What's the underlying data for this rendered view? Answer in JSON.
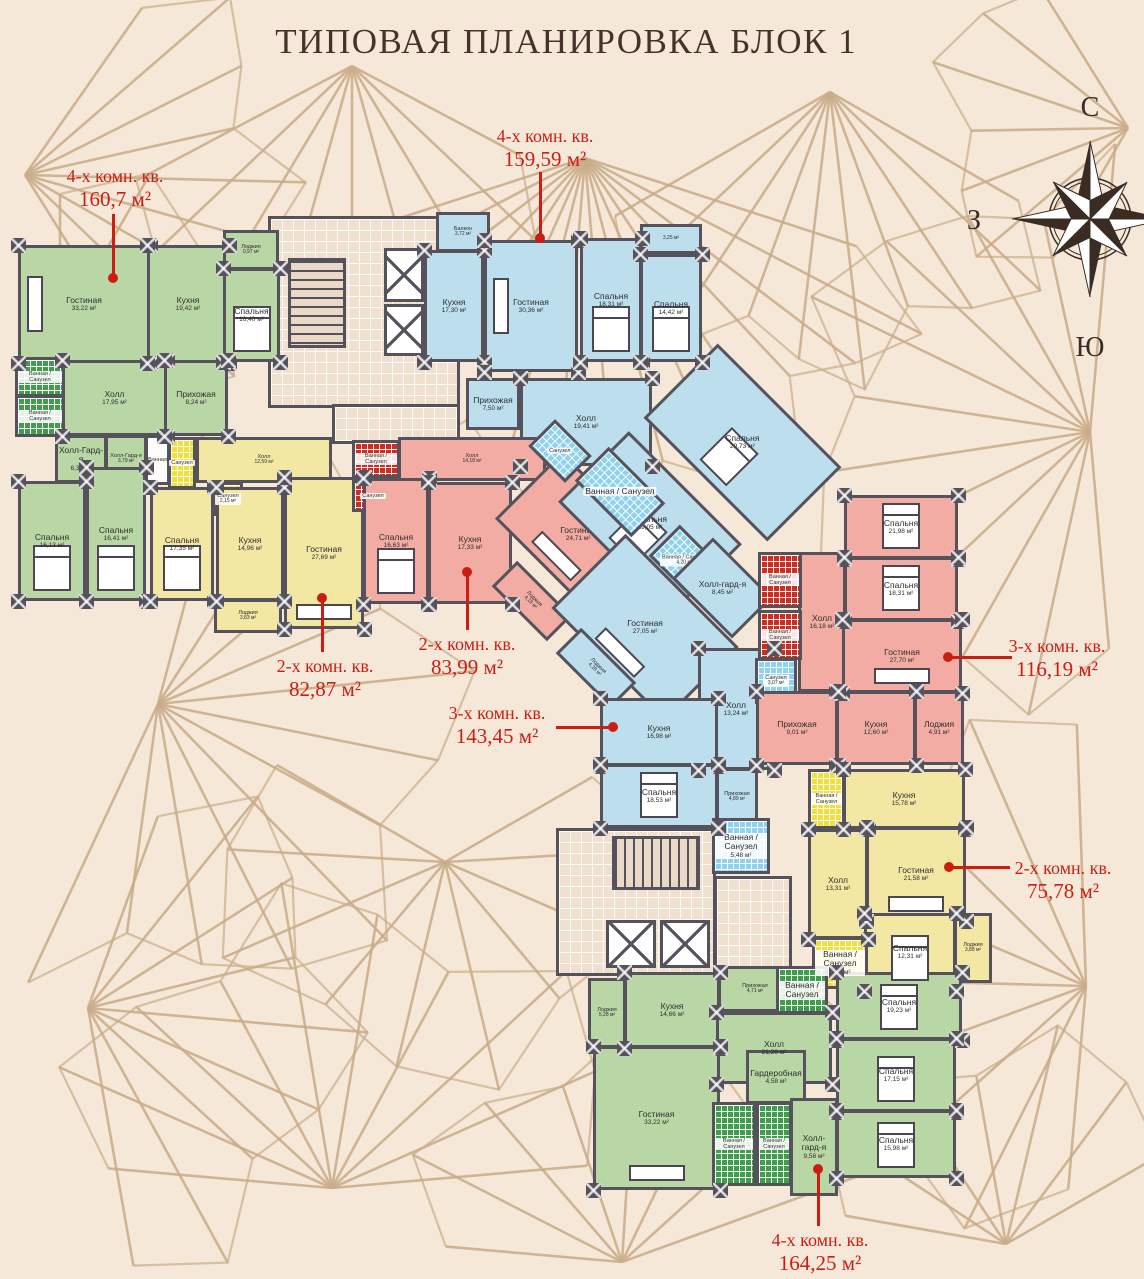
{
  "title": "ТИПОВАЯ ПЛАНИРОВКА БЛОК 1",
  "compass": {
    "north": "С",
    "south": "Ю",
    "west": "З"
  },
  "colors": {
    "background": "#f6e8d9",
    "pattern_line": "#c9ac88",
    "wall": "#55525b",
    "callout_red": "#cc1d12",
    "room_green": "#b9d6a5",
    "room_blue": "#bcdeed",
    "room_yellow": "#f2e7a3",
    "room_pink": "#f2aca4"
  },
  "plan": {
    "rooms": [
      {
        "name": "",
        "area": "",
        "type": "core",
        "x": 268,
        "y": 216,
        "w": 192,
        "h": 192
      },
      {
        "name": "",
        "area": "",
        "type": "core",
        "x": 332,
        "y": 404,
        "w": 128,
        "h": 40
      },
      {
        "name": "",
        "area": "",
        "type": "stairs-v",
        "x": 288,
        "y": 258,
        "w": 58,
        "h": 90
      },
      {
        "name": "",
        "area": "",
        "type": "elev",
        "x": 384,
        "y": 248,
        "w": 40,
        "h": 54
      },
      {
        "name": "",
        "area": "",
        "type": "elev",
        "x": 384,
        "y": 304,
        "w": 40,
        "h": 52
      },
      {
        "name": "",
        "area": "",
        "type": "core",
        "x": 556,
        "y": 828,
        "w": 160,
        "h": 148
      },
      {
        "name": "",
        "area": "",
        "type": "core",
        "x": 714,
        "y": 876,
        "w": 78,
        "h": 100
      },
      {
        "name": "",
        "area": "",
        "type": "stairs-h",
        "x": 612,
        "y": 836,
        "w": 88,
        "h": 54
      },
      {
        "name": "",
        "area": "",
        "type": "elev",
        "x": 606,
        "y": 920,
        "w": 50,
        "h": 48
      },
      {
        "name": "",
        "area": "",
        "type": "elev",
        "x": 660,
        "y": 920,
        "w": 50,
        "h": 48
      },
      {
        "name": "Гостиная",
        "area": "33,22 м²",
        "type": "green",
        "x": 18,
        "y": 245,
        "w": 132,
        "h": 118,
        "furn": "sofa-v"
      },
      {
        "name": "Кухня",
        "area": "19,42 м²",
        "type": "green",
        "x": 147,
        "y": 245,
        "w": 82,
        "h": 118
      },
      {
        "name": "Лоджия",
        "area": "0,97 м²",
        "type": "green",
        "x": 223,
        "y": 230,
        "w": 56,
        "h": 40
      },
      {
        "name": "Спальня",
        "area": "16,40 м²",
        "type": "green",
        "x": 223,
        "y": 268,
        "w": 57,
        "h": 94,
        "furn": "bed"
      },
      {
        "name": "Холл",
        "area": "17,95 м²",
        "type": "green",
        "x": 62,
        "y": 360,
        "w": 105,
        "h": 76
      },
      {
        "name": "Прихожая",
        "area": "8,24 м²",
        "type": "green",
        "x": 164,
        "y": 360,
        "w": 64,
        "h": 76
      },
      {
        "name": "Ванная / Санузел",
        "area": "",
        "type": "tile-green",
        "x": 15,
        "y": 357,
        "w": 50,
        "h": 40
      },
      {
        "name": "Ванная / Санузел",
        "area": "",
        "type": "tile-green",
        "x": 15,
        "y": 395,
        "w": 50,
        "h": 42
      },
      {
        "name": "Холл-Гард-я",
        "area": "6,33 м²",
        "type": "green",
        "x": 55,
        "y": 435,
        "w": 52,
        "h": 48
      },
      {
        "name": "Холл-Гард-я",
        "area": "3,79 м²",
        "type": "green",
        "x": 105,
        "y": 435,
        "w": 42,
        "h": 48
      },
      {
        "name": "Спальня",
        "area": "16,13 м²",
        "type": "green",
        "x": 18,
        "y": 481,
        "w": 68,
        "h": 120,
        "furn": "bed"
      },
      {
        "name": "Спальня",
        "area": "16,41 м²",
        "type": "green",
        "x": 86,
        "y": 467,
        "w": 60,
        "h": 134,
        "furn": "bed"
      },
      {
        "name": "Ванная",
        "area": "",
        "type": "white",
        "x": 145,
        "y": 435,
        "w": 25,
        "h": 50
      },
      {
        "name": "Санузел",
        "area": "",
        "type": "tile-yellow",
        "x": 168,
        "y": 437,
        "w": 28,
        "h": 52
      },
      {
        "name": "Холл",
        "area": "12,59 м²",
        "type": "yellow",
        "x": 196,
        "y": 437,
        "w": 136,
        "h": 46
      },
      {
        "name": "Санузел",
        "area": "2,15 м²",
        "type": "tile-yellow",
        "x": 213,
        "y": 482,
        "w": 30,
        "h": 34
      },
      {
        "name": "Спальня",
        "area": "17,35 м²",
        "type": "yellow",
        "x": 150,
        "y": 487,
        "w": 64,
        "h": 114,
        "furn": "bed"
      },
      {
        "name": "Кухня",
        "area": "14,96 м²",
        "type": "yellow",
        "x": 216,
        "y": 487,
        "w": 68,
        "h": 114
      },
      {
        "name": "Гостиная",
        "area": "27,69 м²",
        "type": "yellow",
        "x": 284,
        "y": 477,
        "w": 80,
        "h": 152,
        "furn": "sofa"
      },
      {
        "name": "Лоджия",
        "area": "3,83 м²",
        "type": "yellow",
        "x": 214,
        "y": 599,
        "w": 68,
        "h": 34
      },
      {
        "name": "Балкон",
        "area": "3,72 м²",
        "type": "blue",
        "x": 436,
        "y": 212,
        "w": 54,
        "h": 40
      },
      {
        "name": "Кухня",
        "area": "17,30 м²",
        "type": "blue",
        "x": 424,
        "y": 250,
        "w": 60,
        "h": 112
      },
      {
        "name": "Гостиная",
        "area": "30,36 м²",
        "type": "blue",
        "x": 484,
        "y": 240,
        "w": 94,
        "h": 132,
        "furn": "sofa-v"
      },
      {
        "name": "Спальня",
        "area": "18,31 м²",
        "type": "blue",
        "x": 580,
        "y": 238,
        "w": 62,
        "h": 124,
        "furn": "bed"
      },
      {
        "name": "",
        "area": "3,25 м²",
        "type": "blue",
        "x": 640,
        "y": 224,
        "w": 62,
        "h": 30
      },
      {
        "name": "Спальня",
        "area": "14,42 м²",
        "type": "blue",
        "x": 640,
        "y": 254,
        "w": 62,
        "h": 108,
        "furn": "bed"
      },
      {
        "name": "Прихожая",
        "area": "7,50 м²",
        "type": "blue",
        "x": 466,
        "y": 378,
        "w": 54,
        "h": 52
      },
      {
        "name": "Холл",
        "area": "19,41 м²",
        "type": "blue",
        "x": 520,
        "y": 378,
        "w": 132,
        "h": 88
      },
      {
        "name": "Спальня",
        "area": "29,73 м²",
        "type": "blue",
        "x": 655,
        "y": 390,
        "w": 175,
        "h": 105,
        "rot": 45,
        "furn": "bed"
      },
      {
        "name": "Холл",
        "area": "14,18 м²",
        "type": "pink",
        "x": 398,
        "y": 437,
        "w": 148,
        "h": 44
      },
      {
        "name": "Ванная / Санузел",
        "area": "",
        "type": "tile-red",
        "x": 352,
        "y": 440,
        "w": 48,
        "h": 38
      },
      {
        "name": "Санузел",
        "area": "",
        "type": "tile-red",
        "x": 352,
        "y": 480,
        "w": 42,
        "h": 32
      },
      {
        "name": "Спальня",
        "area": "16,63 м²",
        "type": "pink",
        "x": 363,
        "y": 478,
        "w": 66,
        "h": 126,
        "furn": "bed"
      },
      {
        "name": "Кухня",
        "area": "17,33 м²",
        "type": "pink",
        "x": 428,
        "y": 482,
        "w": 84,
        "h": 122
      },
      {
        "name": "Гостиная",
        "area": "24,71 м²",
        "type": "pink",
        "x": 508,
        "y": 487,
        "w": 140,
        "h": 95,
        "rot": 45,
        "furn": "sofa"
      },
      {
        "name": "Лоджия",
        "area": "4,18 м²",
        "type": "pink",
        "x": 493,
        "y": 583,
        "w": 78,
        "h": 36,
        "rot": 45,
        "keepRot": 1
      },
      {
        "name": "Санузел",
        "area": "",
        "type": "tile-blue",
        "x": 534,
        "y": 432,
        "w": 52,
        "h": 38,
        "rot": 45
      },
      {
        "name": "Спальня",
        "area": "29,05 м²",
        "type": "blue",
        "x": 570,
        "y": 473,
        "w": 160,
        "h": 100,
        "rot": 45,
        "furn": "bed"
      },
      {
        "name": "Ванная / Санузел",
        "area": "",
        "type": "tile-blue",
        "x": 580,
        "y": 468,
        "w": 80,
        "h": 48,
        "rot": 45
      },
      {
        "name": "Ванная / Санузел",
        "area": "4,20 м²",
        "type": "tile-blue",
        "x": 656,
        "y": 538,
        "w": 56,
        "h": 44,
        "rot": 45
      },
      {
        "name": "Холл-гард-я",
        "area": "8,45 м²",
        "type": "blue",
        "x": 680,
        "y": 559,
        "w": 85,
        "h": 58,
        "rot": 45
      },
      {
        "name": "Гостиная",
        "area": "27,05 м²",
        "type": "blue",
        "x": 565,
        "y": 575,
        "w": 160,
        "h": 105,
        "rot": 45,
        "furn": "sofa"
      },
      {
        "name": "Лоджия",
        "area": "4,28 м²",
        "type": "blue",
        "x": 557,
        "y": 650,
        "w": 78,
        "h": 36,
        "rot": 45,
        "keepRot": 1
      },
      {
        "name": "Холл",
        "area": "13,24 м²",
        "type": "blue",
        "x": 698,
        "y": 648,
        "w": 76,
        "h": 122
      },
      {
        "name": "Санузел",
        "area": "3,07 м²",
        "type": "tile-blue",
        "x": 755,
        "y": 658,
        "w": 42,
        "h": 46
      },
      {
        "name": "Кухня",
        "area": "16,98 м²",
        "type": "blue",
        "x": 600,
        "y": 698,
        "w": 118,
        "h": 68
      },
      {
        "name": "Спальня",
        "area": "18,53 м²",
        "type": "blue",
        "x": 600,
        "y": 764,
        "w": 118,
        "h": 64,
        "furn": "bed"
      },
      {
        "name": "Прихожая",
        "area": "4,89 м²",
        "type": "blue",
        "x": 716,
        "y": 768,
        "w": 42,
        "h": 58
      },
      {
        "name": "Ванная / Санузел",
        "area": "5,48 м²",
        "type": "tile-blue",
        "x": 712,
        "y": 818,
        "w": 58,
        "h": 56
      },
      {
        "name": "Холл",
        "area": "16,18 м²",
        "type": "pink",
        "x": 798,
        "y": 552,
        "w": 48,
        "h": 140
      },
      {
        "name": "Ванная / Санузел",
        "area": "",
        "type": "tile-red",
        "x": 758,
        "y": 552,
        "w": 44,
        "h": 56
      },
      {
        "name": "Ванная / Санузел",
        "area": "",
        "type": "tile-red",
        "x": 758,
        "y": 610,
        "w": 44,
        "h": 50
      },
      {
        "name": "Спальня",
        "area": "21,98 м²",
        "type": "pink",
        "x": 844,
        "y": 495,
        "w": 114,
        "h": 64,
        "furn": "bed"
      },
      {
        "name": "Спальня",
        "area": "18,31 м²",
        "type": "pink",
        "x": 844,
        "y": 557,
        "w": 114,
        "h": 64,
        "furn": "bed"
      },
      {
        "name": "Гостиная",
        "area": "27,70 м²",
        "type": "pink",
        "x": 842,
        "y": 619,
        "w": 120,
        "h": 74,
        "furn": "sofa"
      },
      {
        "name": "Кухня",
        "area": "12,60 м²",
        "type": "pink",
        "x": 836,
        "y": 691,
        "w": 80,
        "h": 74
      },
      {
        "name": "Лоджия",
        "area": "4,91 м²",
        "type": "pink",
        "x": 914,
        "y": 691,
        "w": 50,
        "h": 74
      },
      {
        "name": "Прихожая",
        "area": "9,01 м²",
        "type": "pink",
        "x": 756,
        "y": 691,
        "w": 82,
        "h": 74
      },
      {
        "name": "Кухня",
        "area": "15,78 м²",
        "type": "yellow",
        "x": 843,
        "y": 769,
        "w": 122,
        "h": 60
      },
      {
        "name": "Ванная / Санузел",
        "area": "",
        "type": "tile-yellow",
        "x": 808,
        "y": 769,
        "w": 37,
        "h": 60
      },
      {
        "name": "Холл",
        "area": "13,31 м²",
        "type": "yellow",
        "x": 808,
        "y": 829,
        "w": 60,
        "h": 110
      },
      {
        "name": "Гостиная",
        "area": "21,58 м²",
        "type": "yellow",
        "x": 866,
        "y": 827,
        "w": 100,
        "h": 94,
        "furn": "sofa"
      },
      {
        "name": "Спальня",
        "area": "12,31 м²",
        "type": "yellow",
        "x": 864,
        "y": 913,
        "w": 92,
        "h": 78,
        "furn": "bed"
      },
      {
        "name": "Лоджия",
        "area": "3,88 м²",
        "type": "yellow",
        "x": 954,
        "y": 913,
        "w": 38,
        "h": 70
      },
      {
        "name": "Ванная / Санузел",
        "area": "4,63 м²",
        "type": "tile-yellow",
        "x": 812,
        "y": 937,
        "w": 56,
        "h": 52
      },
      {
        "name": "Лоджия",
        "area": "5,28 м²",
        "type": "green",
        "x": 588,
        "y": 978,
        "w": 38,
        "h": 70
      },
      {
        "name": "Кухня",
        "area": "14,66 м²",
        "type": "green",
        "x": 624,
        "y": 972,
        "w": 96,
        "h": 76
      },
      {
        "name": "Прихожая",
        "area": "4,71 м²",
        "type": "green",
        "x": 718,
        "y": 966,
        "w": 74,
        "h": 46
      },
      {
        "name": "Ванная / Санузел",
        "area": "",
        "type": "tile-green",
        "x": 776,
        "y": 966,
        "w": 52,
        "h": 48
      },
      {
        "name": "Холл",
        "area": "21,26 м²",
        "type": "green",
        "x": 716,
        "y": 1012,
        "w": 116,
        "h": 72
      },
      {
        "name": "Гостиная",
        "area": "33,22 м²",
        "type": "green",
        "x": 593,
        "y": 1046,
        "w": 127,
        "h": 144,
        "furn": "sofa"
      },
      {
        "name": "Гардеробная",
        "area": "4,58 м²",
        "type": "green",
        "x": 746,
        "y": 1050,
        "w": 60,
        "h": 54
      },
      {
        "name": "Холл-гард-я",
        "area": "9,58 м²",
        "type": "green",
        "x": 790,
        "y": 1098,
        "w": 48,
        "h": 98
      },
      {
        "name": "Ванная / Санузел",
        "area": "",
        "type": "tile-green",
        "x": 712,
        "y": 1102,
        "w": 44,
        "h": 84
      },
      {
        "name": "Ванная / Санузел",
        "area": "",
        "type": "tile-green",
        "x": 756,
        "y": 1102,
        "w": 36,
        "h": 84
      },
      {
        "name": "Спальня",
        "area": "19,23 м²",
        "type": "green",
        "x": 836,
        "y": 972,
        "w": 126,
        "h": 68,
        "furn": "bed"
      },
      {
        "name": "Спальня",
        "area": "17,15 м²",
        "type": "green",
        "x": 836,
        "y": 1038,
        "w": 120,
        "h": 74,
        "furn": "bed"
      },
      {
        "name": "Спальня",
        "area": "15,98 м²",
        "type": "green",
        "x": 836,
        "y": 1110,
        "w": 120,
        "h": 68,
        "furn": "bed"
      }
    ],
    "labels": [
      {
        "lines": [
          "4-х комн. кв.",
          "160,7 м²"
        ],
        "cx": 115,
        "y": 166,
        "leader": [
          113,
          214,
          113,
          278
        ]
      },
      {
        "lines": [
          "4-х комн. кв.",
          "159,59 м²"
        ],
        "cx": 545,
        "y": 126,
        "leader": [
          540,
          172,
          540,
          238
        ]
      },
      {
        "lines": [
          "2-х комн. кв.",
          "82,87 м²"
        ],
        "cx": 325,
        "y": 656,
        "leader": [
          322,
          652,
          322,
          598
        ]
      },
      {
        "lines": [
          "2-х комн. кв.",
          "83,99 м²"
        ],
        "cx": 467,
        "y": 634,
        "leader": [
          467,
          630,
          467,
          572
        ]
      },
      {
        "lines": [
          "3-х комн. кв.",
          "143,45 м²"
        ],
        "cx": 497,
        "y": 703,
        "leader": [
          556,
          727,
          613,
          727
        ]
      },
      {
        "lines": [
          "3-х комн. кв.",
          "116,19 м²"
        ],
        "cx": 1057,
        "y": 636,
        "leader": [
          1012,
          657,
          948,
          657
        ]
      },
      {
        "lines": [
          "2-х комн. кв.",
          "75,78 м²"
        ],
        "cx": 1063,
        "y": 858,
        "leader": [
          1010,
          867,
          949,
          867
        ]
      },
      {
        "lines": [
          "4-х комн. кв.",
          "164,25 м²"
        ],
        "cx": 820,
        "y": 1230,
        "leader": [
          818,
          1226,
          818,
          1169
        ]
      }
    ]
  }
}
